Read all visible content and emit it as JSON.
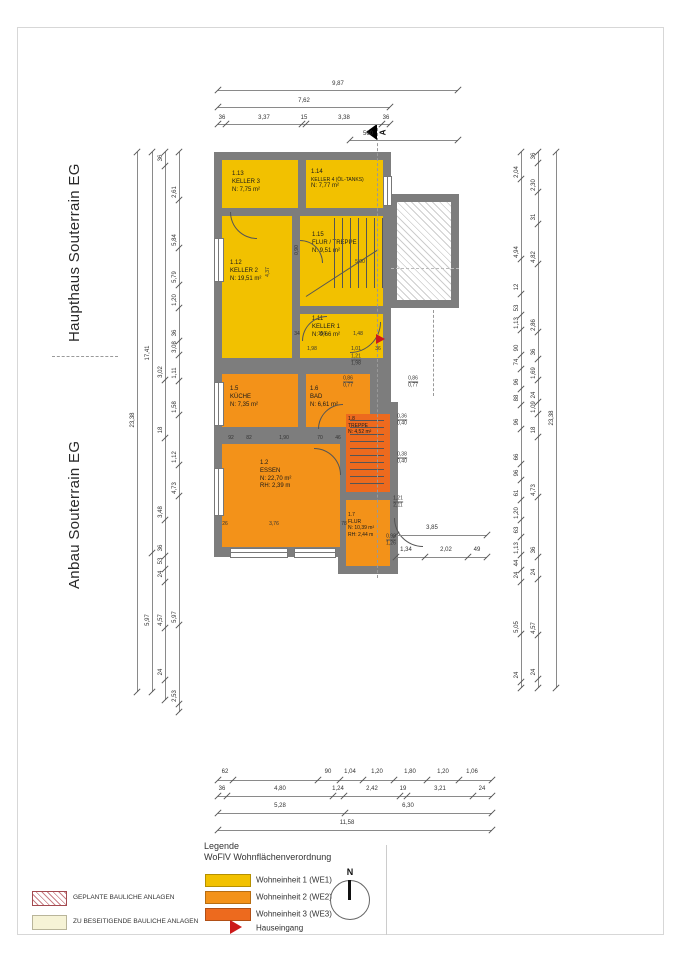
{
  "titles": {
    "haupthaus": "Haupthaus Souterrain EG",
    "anbau": "Anbau Souterrain EG"
  },
  "colors": {
    "we1": "#f2c100",
    "we2": "#f39219",
    "we3": "#ed6a1e",
    "wall": "#7d7d7d",
    "entrance_red": "#cc1a1a"
  },
  "rooms": [
    {
      "number": "1.13",
      "name": "KELLER 3",
      "area": "N: 7,75 m²"
    },
    {
      "number": "1.14",
      "name": "KELLER 4 (ÖL-TANKS)",
      "area": "N: 7,77 m²"
    },
    {
      "number": "1.15",
      "name": "FLUR / TREPPE",
      "area": "N: 9,51 m²"
    },
    {
      "number": "1.12",
      "name": "KELLER 2",
      "area": "N: 19,51 m²"
    },
    {
      "number": "1.11",
      "name": "KELLER 1",
      "area": "N: 9,66 m²"
    },
    {
      "number": "1.5",
      "name": "KÜCHE",
      "area": "N: 7,35 m²"
    },
    {
      "number": "1.6",
      "name": "BAD",
      "area": "N: 6,61 m²"
    },
    {
      "number": "1.8",
      "name": "TREPPE",
      "area": "N: 4,52 m²"
    },
    {
      "number": "1.2",
      "name": "ESSEN",
      "area": "N: 22,70 m²",
      "rh": "RH: 2,39 m"
    },
    {
      "number": "1.7",
      "name": "FLUR",
      "area": "N: 10,39 m²",
      "rh": "RH: 2,44 m"
    }
  ],
  "section_marker": {
    "label": "A"
  },
  "north_label": "N",
  "legend": {
    "title": "Legende",
    "subtitle": "WoFlV Wohnflächenverordnung",
    "items": [
      {
        "label": "Wohneinheit 1 (WE1)",
        "color": "#f2c100"
      },
      {
        "label": "Wohneinheit 2 (WE2)",
        "color": "#f39219"
      },
      {
        "label": "Wohneinheit 3 (WE3)",
        "color": "#ed6a1e"
      }
    ],
    "entrance": "Hauseingang"
  },
  "site_legend": {
    "planned": "GEPLANTE BAULICHE ANLAGEN",
    "remove": "ZU BESEITIGENDE BAULICHE ANLAGEN"
  },
  "dims": {
    "top": {
      "total": "9,87",
      "sub": "7,62",
      "segments": [
        "36",
        "3,37",
        "15",
        "3,38",
        "36"
      ],
      "stair": "560"
    },
    "bottom": {
      "row1": [
        "62",
        "90",
        "1,04",
        "1,20",
        "1,80",
        "1,20",
        "1,06"
      ],
      "row2": [
        "36",
        "4,80",
        "1,24",
        "2,42",
        "19",
        "3,21",
        "24"
      ],
      "row3": [
        "5,28",
        "6,30"
      ],
      "row4": [
        "11,58"
      ]
    },
    "left": {
      "total": "23,38",
      "subtotals": [
        "17,41",
        "5,97"
      ],
      "col_a": [
        "36",
        "3,02",
        "18",
        "3,48",
        "36",
        "53",
        "24",
        "4,57",
        "24"
      ],
      "col_b": [
        "2,61",
        "5,84",
        "5,79",
        "1,20",
        "36",
        "3,08",
        "1,11",
        "1,58",
        "1,12",
        "4,73",
        "5,97",
        "2,53"
      ]
    },
    "right": {
      "total": "23,38",
      "col_a": [
        "2,04",
        "4,94",
        "12",
        "53",
        "1,13",
        "90",
        "74",
        "96",
        "88",
        "96",
        "66",
        "96",
        "61",
        "1,20",
        "63",
        "1,13",
        "44",
        "24",
        "5,05",
        "24"
      ],
      "col_b": [
        "36",
        "2,30",
        "31",
        "4,82",
        "2,86",
        "36",
        "1,69",
        "24",
        "1,09",
        "18",
        "4,73",
        "36",
        "24",
        "4,57",
        "24"
      ]
    },
    "essen_right": {
      "total": "3,85",
      "segments": [
        "1,34",
        "2,02",
        "49"
      ]
    },
    "interior": [
      "4,37",
      "0,90",
      "34",
      "156",
      "1,48",
      "1,98",
      "1,01",
      "36",
      "5,00",
      "92",
      "82",
      "1,90",
      "70",
      "46",
      "26",
      "3,76",
      "78"
    ],
    "stacked": [
      [
        "0,86",
        "0,77"
      ],
      [
        "0,86",
        "0,77"
      ],
      [
        "0,36",
        "0,40"
      ],
      [
        "0,38",
        "0,40"
      ],
      [
        "1,21",
        "2,11"
      ],
      [
        "0,98",
        "1,26"
      ],
      [
        "1,21",
        "1,98"
      ]
    ]
  }
}
